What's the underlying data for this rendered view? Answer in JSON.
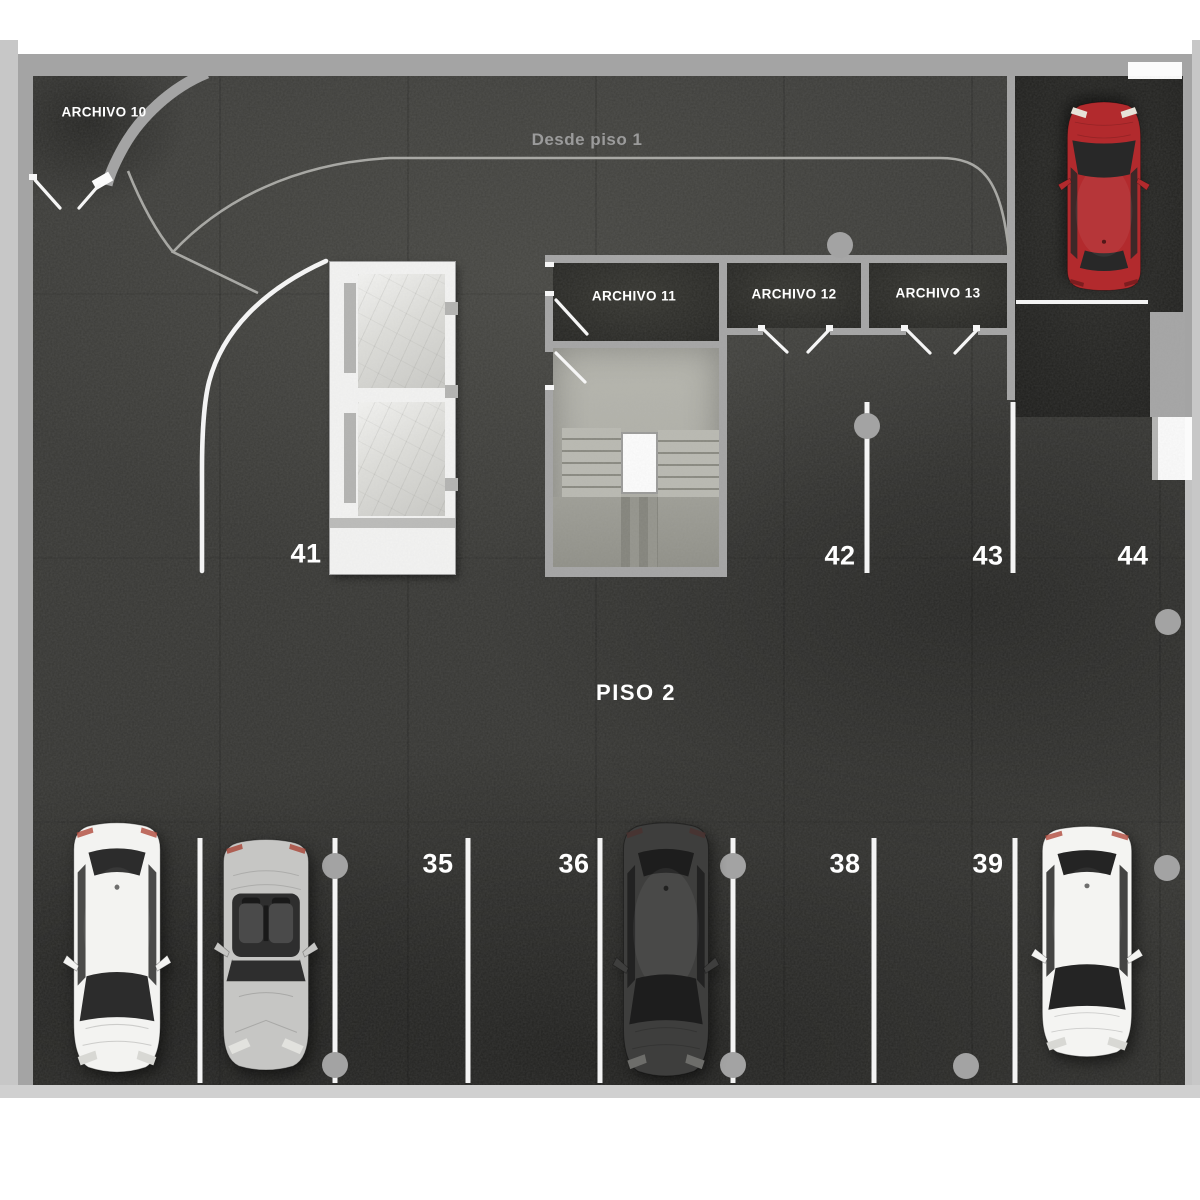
{
  "page": {
    "floor_label": "PISO 2",
    "ramp_label": "Desde piso 1"
  },
  "rooms": [
    {
      "name": "archivo-10",
      "label": "ARCHIVO 10",
      "x": 104,
      "y": 112
    },
    {
      "name": "archivo-11",
      "label": "ARCHIVO 11",
      "x": 634,
      "y": 296
    },
    {
      "name": "archivo-12",
      "label": "ARCHIVO 12",
      "x": 794,
      "y": 294
    },
    {
      "name": "archivo-13",
      "label": "ARCHIVO 13",
      "x": 938,
      "y": 293
    }
  ],
  "parking": {
    "upper_row_numbers": [
      {
        "number": "41",
        "x": 306,
        "y": 554
      },
      {
        "number": "42",
        "x": 840,
        "y": 556
      },
      {
        "number": "43",
        "x": 988,
        "y": 556
      },
      {
        "number": "44",
        "x": 1133,
        "y": 556
      }
    ],
    "lower_row_numbers": [
      {
        "number": "35",
        "x": 438,
        "y": 864
      },
      {
        "number": "36",
        "x": 574,
        "y": 864
      },
      {
        "number": "38",
        "x": 845,
        "y": 864
      },
      {
        "number": "39",
        "x": 988,
        "y": 864
      }
    ]
  },
  "diagram": {
    "divider_lines": [
      {
        "x": 867,
        "y1": 402,
        "y2": 573
      },
      {
        "x": 1013,
        "y1": 402,
        "y2": 573
      },
      {
        "x": 200,
        "y1": 838,
        "y2": 1083
      },
      {
        "x": 335,
        "y1": 838,
        "y2": 1083
      },
      {
        "x": 468,
        "y1": 838,
        "y2": 1083
      },
      {
        "x": 600,
        "y1": 838,
        "y2": 1083
      },
      {
        "x": 733,
        "y1": 838,
        "y2": 1083
      },
      {
        "x": 874,
        "y1": 838,
        "y2": 1083
      },
      {
        "x": 1015,
        "y1": 838,
        "y2": 1083
      }
    ],
    "spot_end_lines": [
      {
        "x1": 1016,
        "y1": 302,
        "x2": 1148,
        "y2": 302
      }
    ],
    "columns": [
      [
        840,
        245
      ],
      [
        867,
        426
      ],
      [
        1168,
        622
      ],
      [
        335,
        866
      ],
      [
        733,
        866
      ],
      [
        1167,
        868
      ],
      [
        335,
        1065
      ],
      [
        733,
        1065
      ],
      [
        966,
        1066
      ]
    ]
  },
  "cars": [
    {
      "name": "car-white-sedan",
      "type": "sedan",
      "facing": "down",
      "x": 58,
      "y": 818,
      "w": 118,
      "h": 262,
      "body": "#f3f3f1",
      "glass": "#2c2c2c",
      "tail": "#b04a3c",
      "light": "#d8d8d4"
    },
    {
      "name": "car-silver-convertible",
      "type": "convertible",
      "facing": "down",
      "x": 208,
      "y": 836,
      "w": 116,
      "h": 238,
      "body": "#c6c6c4",
      "glass": "#2e2e2e",
      "seat": "#4a4a4a",
      "tail": "#a84436",
      "light": "#e2e2de"
    },
    {
      "name": "car-black-sedan",
      "type": "sedan",
      "facing": "down",
      "x": 608,
      "y": 818,
      "w": 116,
      "h": 266,
      "body": "#3e3e3d",
      "glass": "#1d1d1d",
      "tail": "#4a3230",
      "light": "#6d6d6a"
    },
    {
      "name": "car-white-hatchback",
      "type": "sedan",
      "facing": "down",
      "x": 1026,
      "y": 822,
      "w": 122,
      "h": 242,
      "body": "#f4f4f2",
      "glass": "#242424",
      "tail": "#b04a3c",
      "light": "#d8d8d4"
    },
    {
      "name": "car-red-sedan",
      "type": "sedan",
      "facing": "up",
      "x": 1054,
      "y": 96,
      "w": 100,
      "h": 198,
      "body": "#b22a2d",
      "glass": "#282828",
      "tail": "#6e1a1c",
      "light": "#e6e2d8"
    }
  ],
  "colors": {
    "floor": "#3a3a37",
    "wall": "#a4a4a4",
    "marking": "#f4f4f4",
    "column": "#a3a3a3",
    "ramp_line": "#a8a8a4",
    "label": "#ffffff",
    "ramp_label": "#9b9b9b"
  }
}
